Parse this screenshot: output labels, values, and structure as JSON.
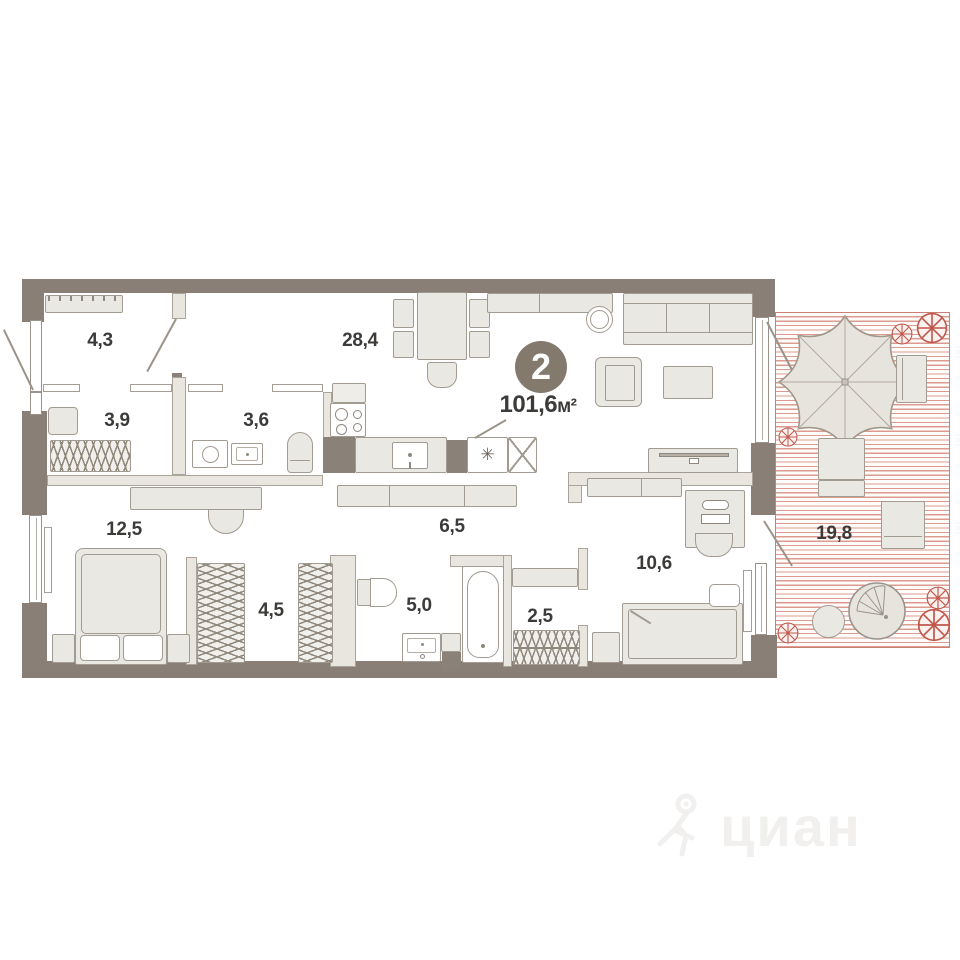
{
  "floorplan": {
    "badge": {
      "rooms_count": "2",
      "area_value": "101,6",
      "area_unit": "м²"
    },
    "rooms": {
      "hall": {
        "name": "entry hall",
        "area": "4,3"
      },
      "dressing": {
        "name": "dressing room",
        "area": "3,9"
      },
      "bath_small": {
        "name": "wc / laundry room",
        "area": "3,6"
      },
      "kitchen_living": {
        "name": "kitchen-living",
        "area": "28,4"
      },
      "bedroom": {
        "name": "bedroom",
        "area": "12,5"
      },
      "closet": {
        "name": "walk-in closet",
        "area": "4,5"
      },
      "bathroom": {
        "name": "bathroom",
        "area": "5,0"
      },
      "laundry": {
        "name": "drying room",
        "area": "2,5"
      },
      "corridor": {
        "name": "corridor",
        "area": "6,5"
      },
      "kids_room": {
        "name": "second bedroom",
        "area": "10,6"
      },
      "terrace": {
        "name": "terrace",
        "area": "19,8"
      }
    },
    "icons": {
      "snowflake": "✳"
    },
    "watermark": {
      "text": "циан"
    },
    "colors": {
      "wall": "#897f76",
      "badge_circle": "#84796d",
      "furniture_fill": "#eae8e2",
      "furniture_stroke": "#a29b91",
      "terrace_stripe": "#dc9a90",
      "terrace_accent": "#c0584c",
      "label_text": "#3c3b39"
    }
  }
}
